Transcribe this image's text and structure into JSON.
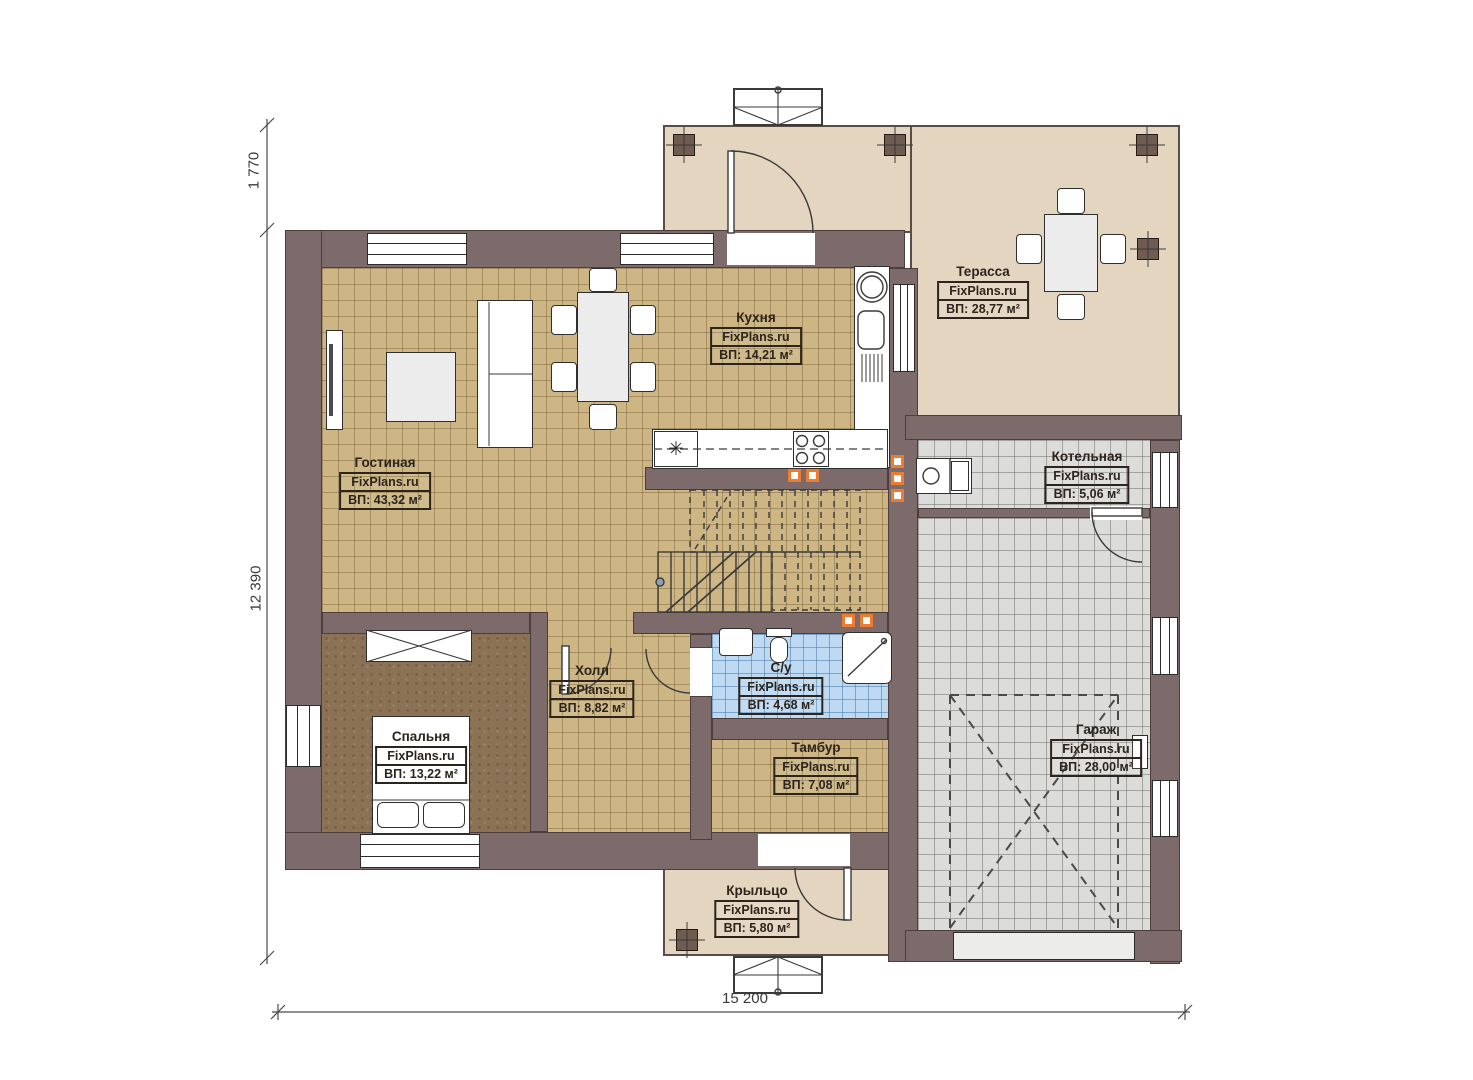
{
  "plan": {
    "rooms": {
      "living": {
        "name": "Гостиная",
        "brand": "FixPlans.ru",
        "area": "ВП: 43,32 м²"
      },
      "kitchen": {
        "name": "Кухня",
        "brand": "FixPlans.ru",
        "area": "ВП: 14,21 м²"
      },
      "terrace": {
        "name": "Терасса",
        "brand": "FixPlans.ru",
        "area": "ВП: 28,77 м²"
      },
      "boiler": {
        "name": "Котельная",
        "brand": "FixPlans.ru",
        "area": "ВП: 5,06 м²"
      },
      "hall": {
        "name": "Холл",
        "brand": "FixPlans.ru",
        "area": "ВП: 8,82 м²"
      },
      "wc": {
        "name": "С/у",
        "brand": "FixPlans.ru",
        "area": "ВП: 4,68 м²"
      },
      "bedroom": {
        "name": "Спальня",
        "brand": "FixPlans.ru",
        "area": "ВП: 13,22 м²"
      },
      "tambour": {
        "name": "Тамбур",
        "brand": "FixPlans.ru",
        "area": "ВП: 7,08 м²"
      },
      "garage": {
        "name": "Гараж",
        "brand": "FixPlans.ru",
        "area": "ВП: 28,00 м²"
      },
      "porch": {
        "name": "Крыльцо",
        "brand": "FixPlans.ru",
        "area": "ВП: 5,80 м²"
      }
    },
    "dimensions": {
      "left_upper": "1 770",
      "left_total": "12 390",
      "bottom_total": "15 200"
    },
    "icons": {
      "asterisk": "✳"
    },
    "colors": {
      "wall": "#7d6a6a",
      "floor_wood": "#cdb684",
      "floor_bedroom": "#8b7254",
      "floor_tile": "#dcdcda",
      "floor_bath": "#bedaf2",
      "outdoor": "#e4d5c0",
      "vent": "#ee7c30"
    }
  }
}
